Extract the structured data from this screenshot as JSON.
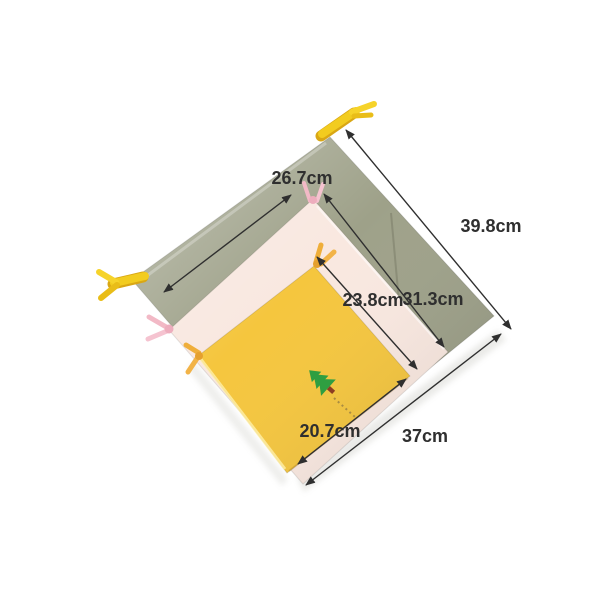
{
  "background_color": "#ffffff",
  "bags": {
    "large": {
      "fabric_color": "#9ea189",
      "drawstring_color": "#f2cc1f"
    },
    "medium": {
      "fabric_color": "#f9e8e0",
      "drawstring_color": "#f2b9c6"
    },
    "small": {
      "fabric_color": "#f5c63e",
      "drawstring_color": "#efae3a"
    }
  },
  "logo": {
    "icon": "pine-tree-icon",
    "tree_color": "#2f9e41",
    "trunk_color": "#8d3d22"
  },
  "measurements": {
    "medium_width": "26.7cm",
    "large_length": "39.8cm",
    "medium_length": "31.3cm",
    "small_length": "23.8cm",
    "small_width": "20.7cm",
    "large_width": "37cm"
  },
  "annotation_color": "#2f2f2f"
}
